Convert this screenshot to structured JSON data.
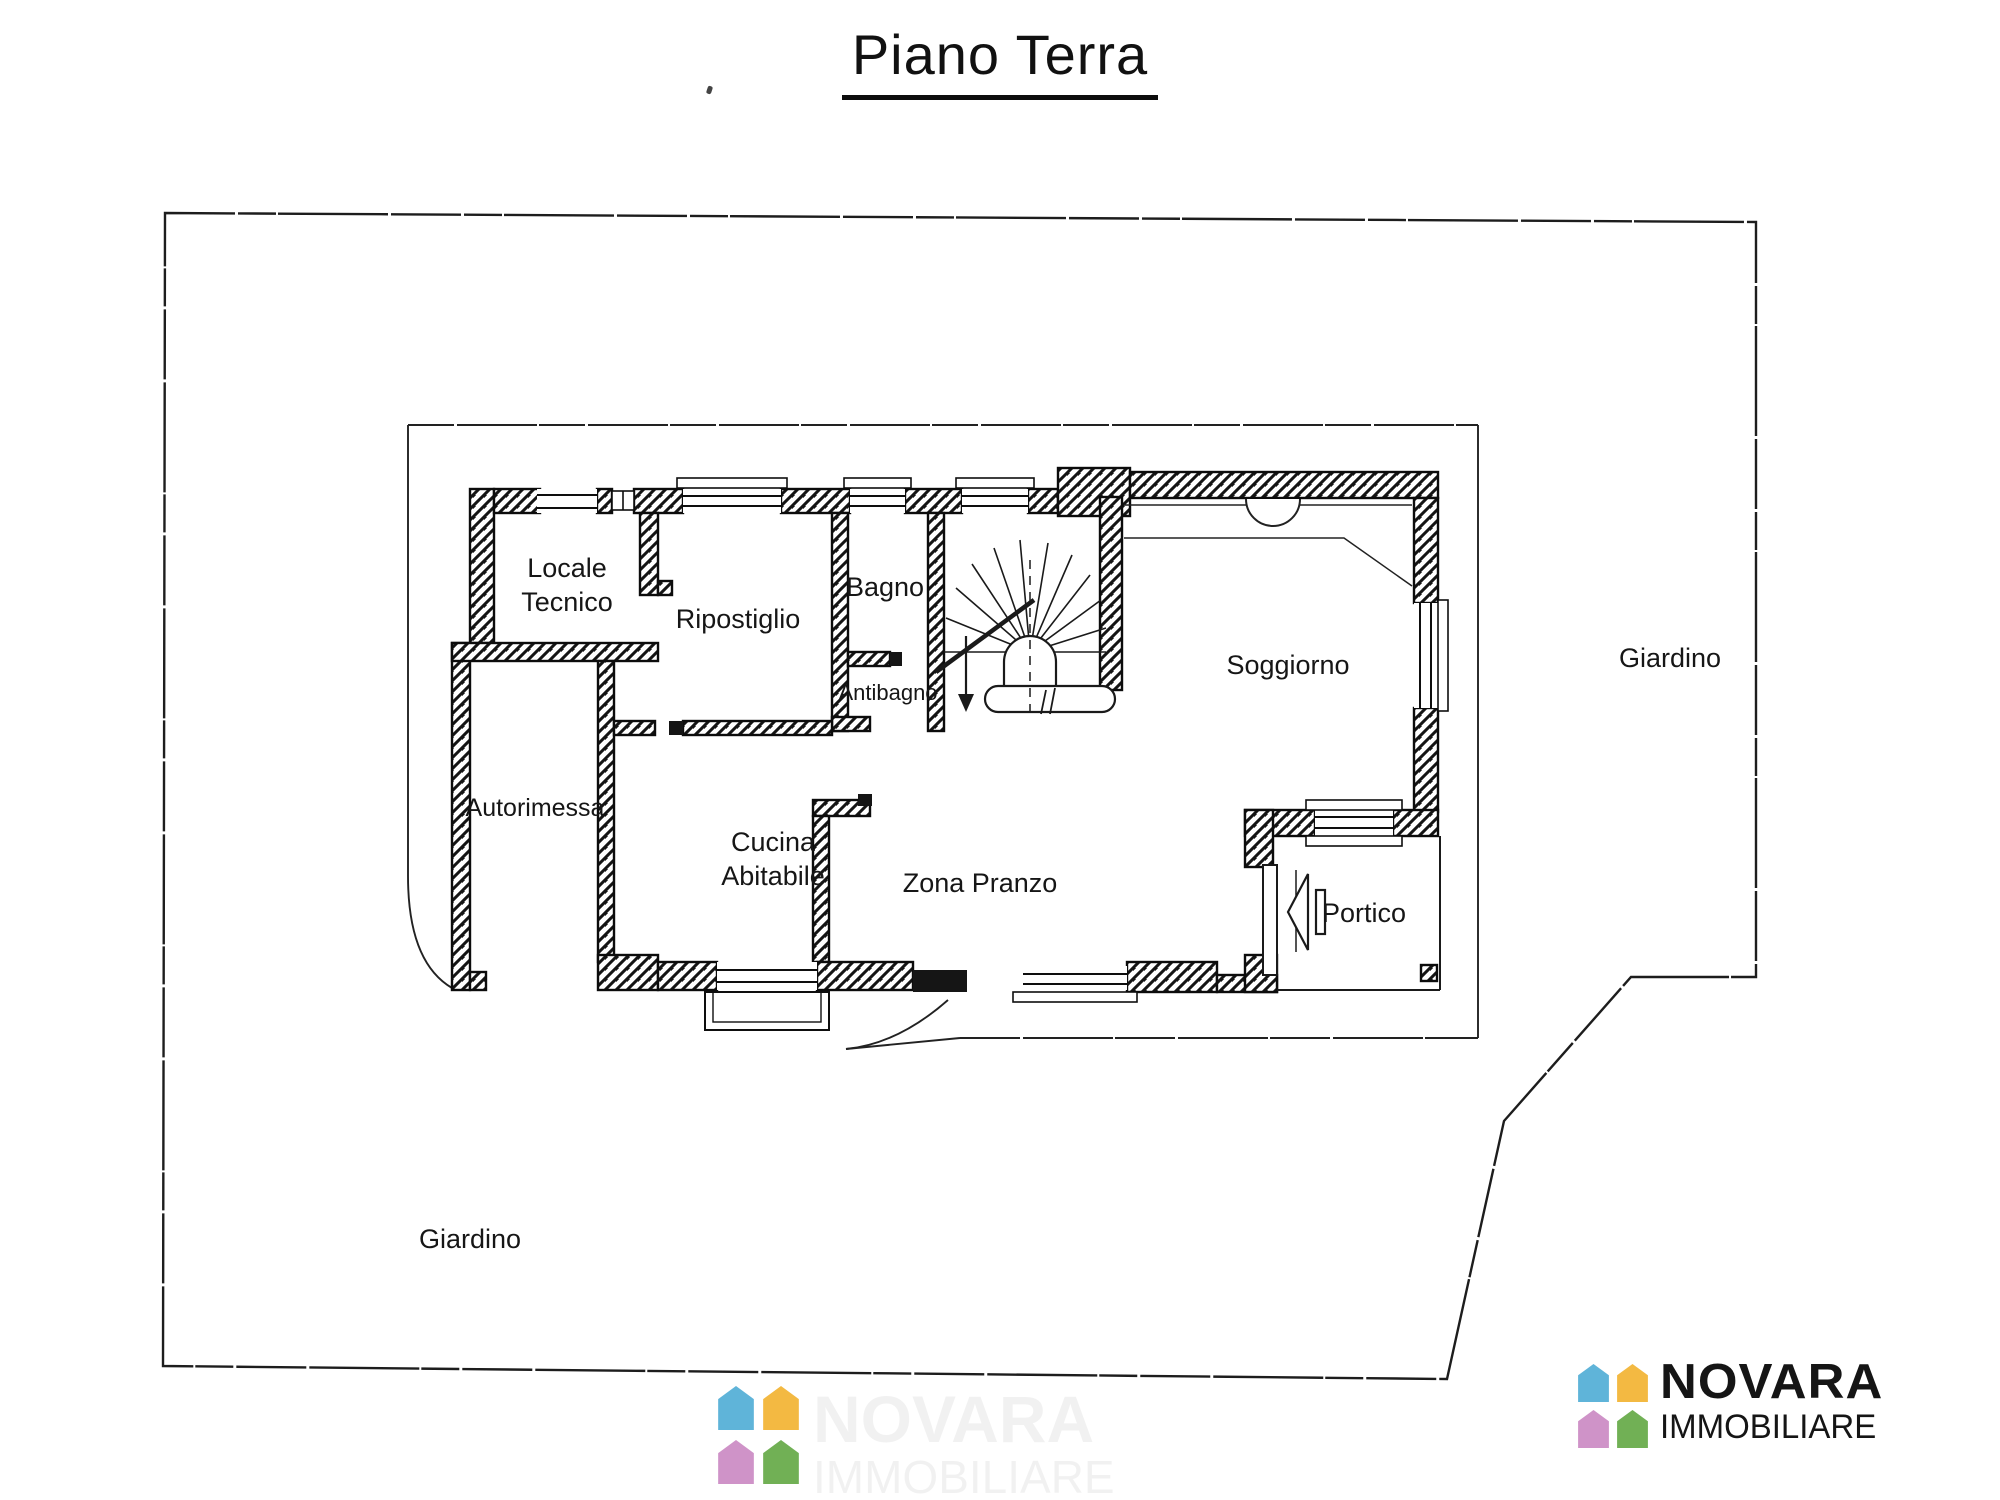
{
  "title": "Piano Terra",
  "labels": {
    "locale_tecnico_1": "Locale",
    "locale_tecnico_2": "Tecnico",
    "ripostiglio": "Ripostiglio",
    "bagno": "Bagno",
    "antibagno": "Antibagno",
    "soggiorno": "Soggiorno",
    "autorimessa": "Autorimessa",
    "cucina_1": "Cucina",
    "cucina_2": "Abitabile",
    "zona_pranzo": "Zona Pranzo",
    "portico": "Portico",
    "giardino_right": "Giardino",
    "giardino_left": "Giardino"
  },
  "logo": {
    "brand": "NOVARA",
    "brand_sub": "IMMOBILIARE"
  },
  "watermark": {
    "brand": "NOVARA",
    "brand_sub": "IMMOBILIARE"
  },
  "colors": {
    "ink": "#111111",
    "pentagon_blue": "#5fb4d9",
    "pentagon_yellow": "#f3b942",
    "pentagon_pink": "#cf93c8",
    "pentagon_green": "#71b055"
  }
}
